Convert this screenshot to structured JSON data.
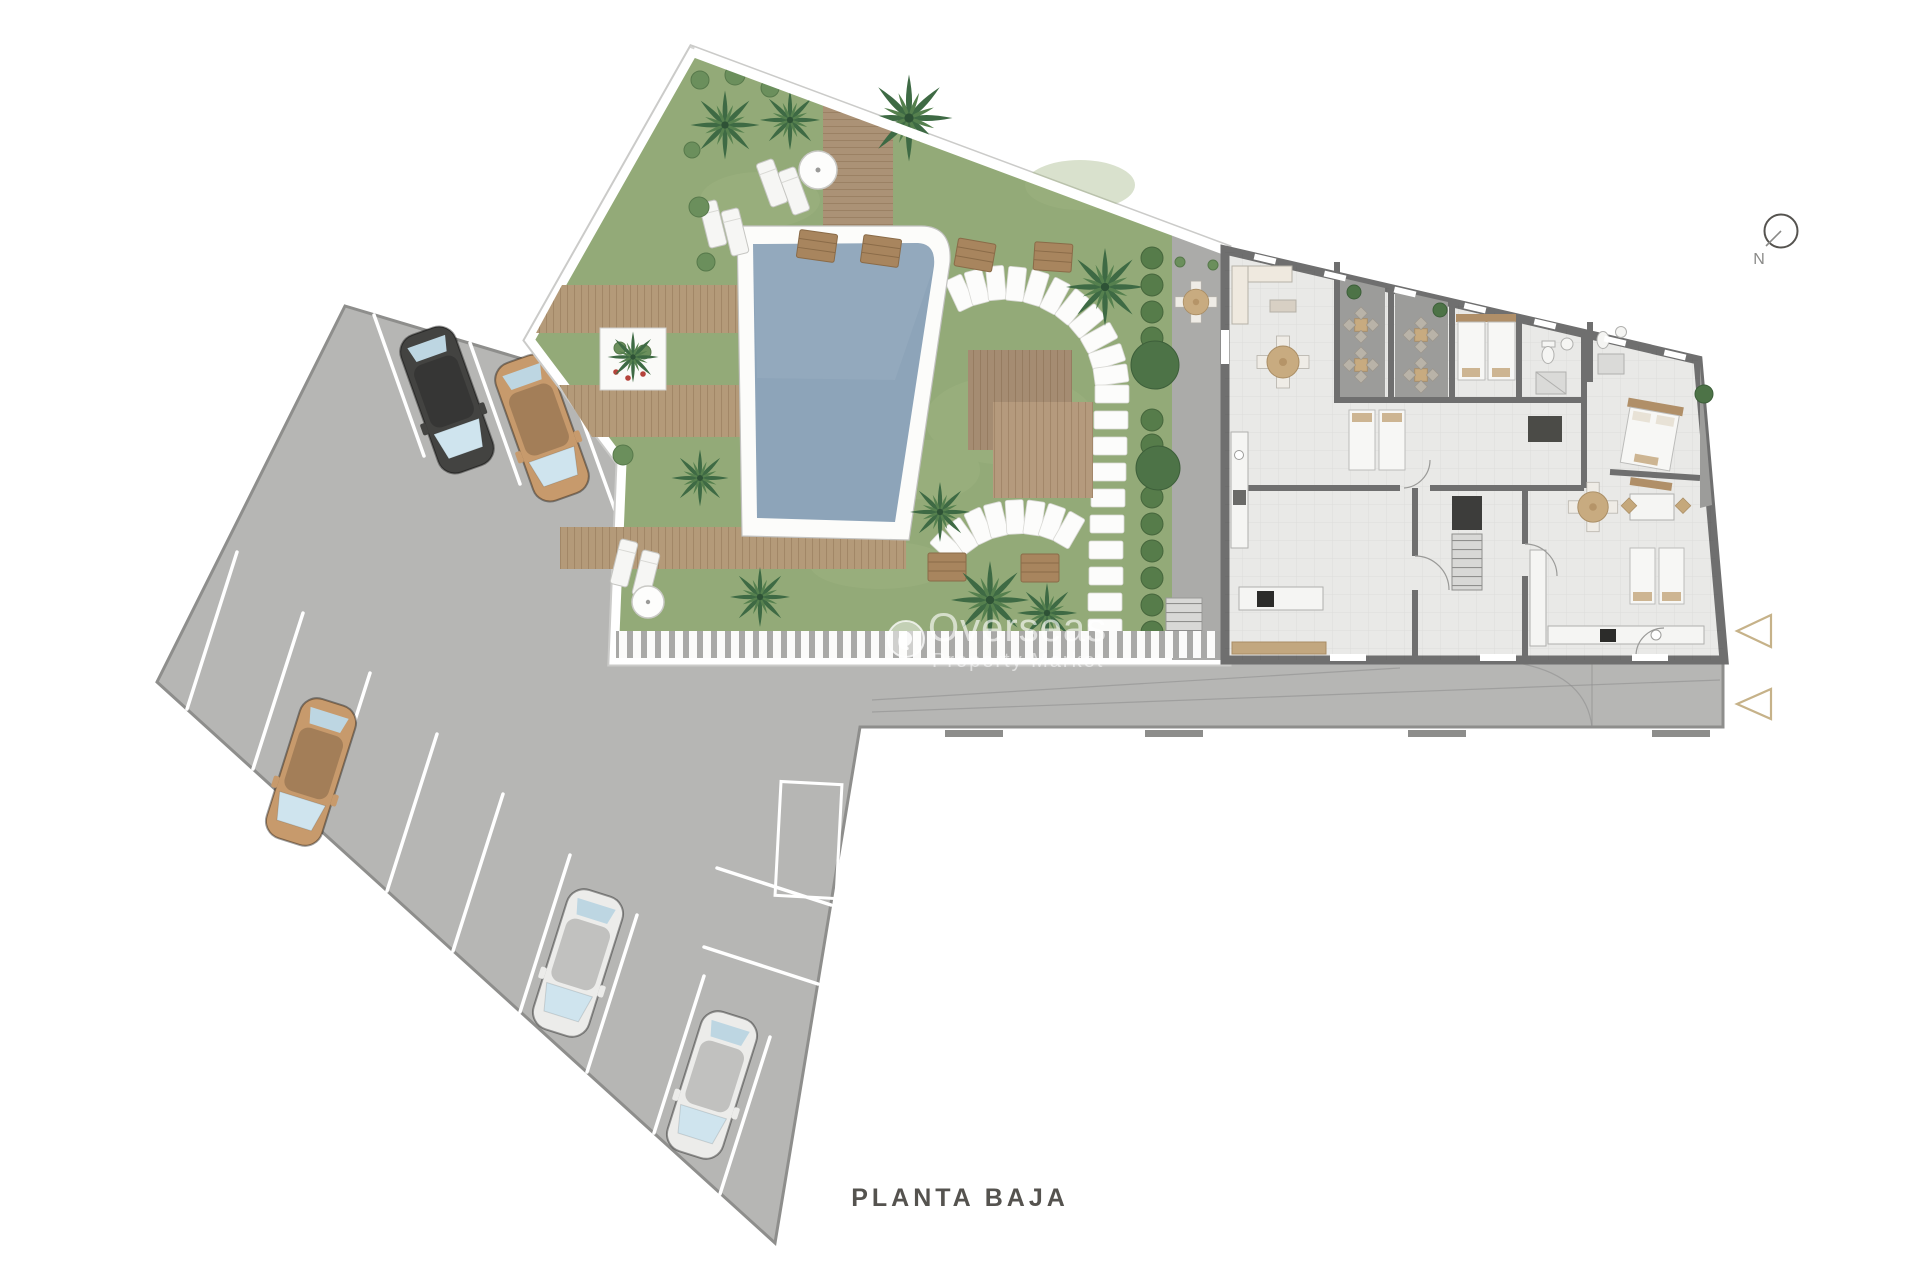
{
  "page": {
    "title": "PLANTA BAJA"
  },
  "compass": {
    "label": "N"
  },
  "watermark": {
    "line1": "Overseas",
    "line2": "Property Market"
  },
  "colors": {
    "background": "#ffffff",
    "asphalt": "#b6b6b4",
    "asphalt_edge": "#8e8e8c",
    "grass": "#93aa78",
    "pool_water": "#8da4b9",
    "deck_wood": "#b49a79",
    "deck_wood_dark": "#a58c72",
    "building_floor": "#e9e9e7",
    "building_wall": "#6f6f6f",
    "terrace_floor": "#9c9c9a",
    "paving": "#ababa9",
    "hedge_green": "#567c4a",
    "palm_green": "#3e6a44",
    "marker_outline": "#c6b289",
    "car_black": "#434341",
    "car_tan": "#c79a6c",
    "car_white": "#ececea",
    "title_text": "#55534f"
  }
}
